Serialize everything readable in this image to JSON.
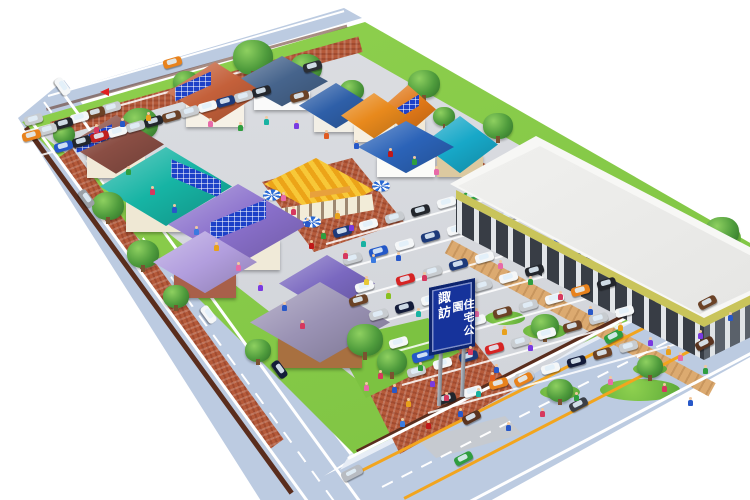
{
  "sign": {
    "line1": "諏訪",
    "line2": "住宅公園",
    "bg": "#16339b",
    "border": "#0d246e",
    "text_color": "#ffffff"
  },
  "palette": {
    "road": "#bccbe1",
    "sidewalk": "#e7edf6",
    "grass": "#7cc241",
    "grassLight": "#90d14f",
    "asphalt": "#d6d8dc",
    "brick": "#b55a3a",
    "tan": "#dcaa70",
    "band": "#c9c45a",
    "wallbrown": "#5a2d1d",
    "signBlue": "#16339b",
    "signBorder": "#0d246e",
    "lineOrange": "#f2a51e",
    "lineWhite": "#ffffff",
    "solarBlue": "#1d41c8"
  },
  "houses": [
    {
      "id": "spanish-tile-solar",
      "x": 215,
      "y": 98,
      "w": 96,
      "h": 72,
      "roof": "#c4603a",
      "wall": "#f6f1e6",
      "solar": "left"
    },
    {
      "id": "modern-white",
      "x": 282,
      "y": 86,
      "w": 92,
      "h": 60,
      "roof": "#46648c",
      "wall": "#fafafa",
      "solar": ""
    },
    {
      "id": "navy-roof",
      "x": 336,
      "y": 110,
      "w": 74,
      "h": 54,
      "roof": "#2e5fa8",
      "wall": "#f2efe6",
      "solar": ""
    },
    {
      "id": "orange-awning",
      "x": 374,
      "y": 120,
      "w": 66,
      "h": 54,
      "roof": "#e8891c",
      "wall": "#f6efe0",
      "solar": ""
    },
    {
      "id": "solar-gable",
      "x": 408,
      "y": 114,
      "w": 56,
      "h": 58,
      "roof": "#e07818",
      "wall": "#f2ead8",
      "solar": "center"
    },
    {
      "id": "blue-awning",
      "x": 406,
      "y": 152,
      "w": 96,
      "h": 62,
      "roof": "#2b63b8",
      "wall": "#fbfbf8",
      "solar": ""
    },
    {
      "id": "teal-mediterranean",
      "x": 460,
      "y": 150,
      "w": 76,
      "h": 68,
      "roof": "#17a8c8",
      "wall": "#dcc9a0",
      "solar": ""
    },
    {
      "id": "maroon-solar",
      "x": 116,
      "y": 150,
      "w": 96,
      "h": 70,
      "roof": "#8a4e44",
      "wall": "#f2ead8",
      "solar": "left"
    },
    {
      "id": "teal-big-solar",
      "x": 166,
      "y": 194,
      "w": 132,
      "h": 94,
      "roof": "#16b4a4",
      "wall": "#efe8d4",
      "solar": "right"
    },
    {
      "id": "violet-solar",
      "x": 238,
      "y": 232,
      "w": 140,
      "h": 96,
      "roof": "#8a70cc",
      "wall": "#f0ead8",
      "solar": "center"
    },
    {
      "id": "lavender-hip",
      "x": 205,
      "y": 268,
      "w": 104,
      "h": 74,
      "roof": "#b29ede",
      "wall": "#a8604a",
      "solar": ""
    },
    {
      "id": "purple-hip",
      "x": 327,
      "y": 289,
      "w": 96,
      "h": 68,
      "roof": "#7a68c0",
      "wall": "#8a5438",
      "solar": ""
    },
    {
      "id": "wood-lodge",
      "x": 320,
      "y": 330,
      "w": 140,
      "h": 96,
      "roof": "#9a92b4",
      "wall": "#a87040",
      "solar": ""
    }
  ],
  "cars": [
    [
      172,
      62,
      "#e8821c",
      -16
    ],
    [
      62,
      86,
      "#f5f7f8",
      54
    ],
    [
      86,
      198,
      "#9aa0a6",
      54
    ],
    [
      208,
      314,
      "#f5f7f8",
      54
    ],
    [
      279,
      369,
      "#141c3a",
      54
    ],
    [
      352,
      473,
      "#b8bcc2",
      -27,
      1
    ],
    [
      523,
      379,
      "#e8821c",
      -27
    ],
    [
      578,
      404,
      "#3a3f47",
      -27
    ],
    [
      471,
      417,
      "#5a3420",
      -27
    ],
    [
      463,
      458,
      "#2f9e3f",
      -27
    ],
    [
      613,
      336,
      "#2f9e3f",
      -27
    ],
    [
      704,
      343,
      "#5a3420",
      -27
    ],
    [
      707,
      302,
      "#6b4226",
      -27
    ],
    [
      33,
      119,
      "#c8ccd0",
      -15.5
    ],
    [
      31,
      135,
      "#e8821c",
      -15.5
    ],
    [
      47,
      129,
      "#c8ccd0",
      -15.5
    ],
    [
      63,
      123,
      "#23262c",
      -15.5
    ],
    [
      79,
      117,
      "#f5f7f8",
      -15.5
    ],
    [
      95,
      112,
      "#6b4226",
      -15.5
    ],
    [
      111,
      107,
      "#c8ccd0",
      -15.5
    ],
    [
      63,
      146,
      "#2458c8",
      -15.5
    ],
    [
      81,
      141,
      "#23262c",
      -15.5
    ],
    [
      99,
      136,
      "#c02020",
      -15.5
    ],
    [
      117,
      131,
      "#f5f7f8",
      -15.5
    ],
    [
      135,
      126,
      "#c8ccd0",
      -15.5
    ],
    [
      153,
      121,
      "#23262c",
      -15.5
    ],
    [
      171,
      116,
      "#6b4226",
      -15.5
    ],
    [
      189,
      111,
      "#c8ccd0",
      -15.5
    ],
    [
      207,
      106,
      "#f5f7f8",
      -15.5
    ],
    [
      225,
      101,
      "#1d3a7a",
      -15.5
    ],
    [
      243,
      96,
      "#c8ccd0",
      -15.5
    ],
    [
      261,
      91,
      "#23262c",
      -15.5
    ],
    [
      312,
      66,
      "#2a2e34",
      -15.5
    ],
    [
      299,
      96,
      "#6b4226",
      -15.5
    ],
    [
      342,
      231,
      "#1d3a7a",
      -15.5
    ],
    [
      368,
      224,
      "#f5f7f8",
      -15.5
    ],
    [
      394,
      217,
      "#c8ccd0",
      -15.5
    ],
    [
      420,
      210,
      "#23262c",
      -15.5
    ],
    [
      446,
      202,
      "#f5f7f8",
      -15.5
    ],
    [
      472,
      195,
      "#2f9e3f",
      -15.5
    ],
    [
      498,
      188,
      "#c8ccd0",
      -15.5
    ],
    [
      352,
      258,
      "#c8ccd0",
      -15.5
    ],
    [
      378,
      251,
      "#2458c8",
      -15.5
    ],
    [
      404,
      244,
      "#f5f7f8",
      -15.5
    ],
    [
      430,
      236,
      "#1d3a7a",
      -15.5
    ],
    [
      456,
      229,
      "#f5f7f8",
      -15.5
    ],
    [
      482,
      222,
      "#23262c",
      -15.5
    ],
    [
      508,
      215,
      "#c8ccd0",
      -15.5
    ],
    [
      534,
      207,
      "#6b4226",
      -15.5
    ],
    [
      364,
      286,
      "#f5f7f8",
      -15.5
    ],
    [
      405,
      279,
      "#d62424",
      -15.5
    ],
    [
      432,
      271,
      "#c8ccd0",
      -15.5
    ],
    [
      458,
      264,
      "#1d3a7a",
      -15.5
    ],
    [
      484,
      257,
      "#f5f7f8",
      -15.5
    ],
    [
      510,
      249,
      "#23262c",
      -15.5
    ],
    [
      536,
      242,
      "#c8ccd0",
      -15.5
    ],
    [
      562,
      235,
      "#2458c8",
      -15.5
    ],
    [
      378,
      314,
      "#c8ccd0",
      -15.5
    ],
    [
      404,
      307,
      "#141c3a",
      -15.5
    ],
    [
      430,
      299,
      "#f5f7f8",
      -15.5
    ],
    [
      456,
      292,
      "#6b4226",
      -15.5
    ],
    [
      482,
      285,
      "#c8ccd0",
      -15.5
    ],
    [
      508,
      277,
      "#f5f7f8",
      -15.5
    ],
    [
      534,
      270,
      "#23262c",
      -15.5
    ],
    [
      560,
      263,
      "#c8ccd0",
      -15.5
    ],
    [
      586,
      255,
      "#1d3a7a",
      -15.5
    ],
    [
      398,
      342,
      "#f5f7f8",
      -15.5
    ],
    [
      423,
      356,
      "#2458c8",
      -15.5,
      1
    ],
    [
      450,
      327,
      "#141c3a",
      -15.5
    ],
    [
      476,
      320,
      "#f5f7f8",
      -15.5
    ],
    [
      502,
      312,
      "#6b4226",
      -15.5
    ],
    [
      528,
      305,
      "#c8ccd0",
      -15.5
    ],
    [
      554,
      298,
      "#f5f7f8",
      -15.5
    ],
    [
      580,
      290,
      "#e8821c",
      -15.5
    ],
    [
      606,
      283,
      "#23262c",
      -15.5
    ],
    [
      416,
      371,
      "#c8ccd0",
      -15.5
    ],
    [
      442,
      363,
      "#f5f7f8",
      -15.5
    ],
    [
      468,
      356,
      "#1d3a7a",
      -15.5
    ],
    [
      494,
      348,
      "#d62424",
      -15.5
    ],
    [
      520,
      341,
      "#c8ccd0",
      -15.5
    ],
    [
      546,
      333,
      "#f5f7f8",
      -15.5
    ],
    [
      572,
      326,
      "#6b4226",
      -15.5
    ],
    [
      598,
      318,
      "#c8ccd0",
      -15.5
    ],
    [
      624,
      311,
      "#f5f7f8",
      -15.5
    ],
    [
      446,
      398,
      "#23262c",
      -15.5
    ],
    [
      472,
      391,
      "#f5f7f8",
      -15.5
    ],
    [
      498,
      383,
      "#e8821c",
      -15.5
    ],
    [
      524,
      376,
      "#c8ccd0",
      -15.5
    ],
    [
      550,
      368,
      "#f5f7f8",
      -15.5
    ],
    [
      576,
      361,
      "#141c3a",
      -15.5
    ],
    [
      602,
      353,
      "#6b4226",
      -15.5
    ],
    [
      628,
      346,
      "#c8ccd0",
      -15.5
    ],
    [
      358,
      300,
      "#6b4226",
      -15.5
    ]
  ],
  "trees": [
    [
      140,
      126,
      36
    ],
    [
      97,
      148,
      30
    ],
    [
      64,
      136,
      22
    ],
    [
      186,
      84,
      26
    ],
    [
      253,
      60,
      40
    ],
    [
      306,
      70,
      32
    ],
    [
      352,
      92,
      24
    ],
    [
      424,
      86,
      32
    ],
    [
      444,
      118,
      22
    ],
    [
      498,
      128,
      30
    ],
    [
      108,
      208,
      32
    ],
    [
      143,
      256,
      32
    ],
    [
      176,
      298,
      26
    ],
    [
      322,
      298,
      24
    ],
    [
      258,
      352,
      26
    ],
    [
      365,
      342,
      36
    ],
    [
      392,
      364,
      30
    ],
    [
      545,
      328,
      28
    ],
    [
      560,
      392,
      26
    ],
    [
      650,
      368,
      26
    ],
    [
      722,
      234,
      34
    ],
    [
      736,
      258,
      24
    ]
  ],
  "people_colors": [
    "#d6385e",
    "#e86aa8",
    "#2858c8",
    "#2f9e3f",
    "#e8a11c",
    "#7a3ae0",
    "#18b2a2",
    "#e05a20",
    "#c01818",
    "#3a7ae0",
    "#88c020",
    "#e8c838"
  ],
  "people": [
    [
      96,
      133,
      0
    ],
    [
      122,
      127,
      2
    ],
    [
      148,
      121,
      4
    ],
    [
      210,
      127,
      1
    ],
    [
      240,
      131,
      3
    ],
    [
      266,
      125,
      6
    ],
    [
      296,
      129,
      5
    ],
    [
      326,
      139,
      7
    ],
    [
      356,
      149,
      2
    ],
    [
      390,
      157,
      8
    ],
    [
      414,
      165,
      3
    ],
    [
      436,
      175,
      1
    ],
    [
      128,
      175,
      3
    ],
    [
      152,
      195,
      0
    ],
    [
      174,
      213,
      2
    ],
    [
      196,
      235,
      9
    ],
    [
      216,
      251,
      4
    ],
    [
      238,
      271,
      1
    ],
    [
      260,
      291,
      5
    ],
    [
      284,
      311,
      2
    ],
    [
      302,
      329,
      0
    ],
    [
      283,
      201,
      1
    ],
    [
      293,
      215,
      0
    ],
    [
      307,
      227,
      2
    ],
    [
      323,
      239,
      3
    ],
    [
      337,
      219,
      4
    ],
    [
      351,
      231,
      5
    ],
    [
      363,
      247,
      6
    ],
    [
      345,
      259,
      0
    ],
    [
      311,
      249,
      8
    ],
    [
      373,
      263,
      9
    ],
    [
      398,
      261,
      2
    ],
    [
      424,
      281,
      0
    ],
    [
      450,
      299,
      3
    ],
    [
      476,
      317,
      1
    ],
    [
      504,
      335,
      4
    ],
    [
      530,
      351,
      5
    ],
    [
      418,
      317,
      6
    ],
    [
      446,
      337,
      7
    ],
    [
      470,
      355,
      0
    ],
    [
      496,
      373,
      2
    ],
    [
      388,
      299,
      10
    ],
    [
      366,
      285,
      11
    ],
    [
      500,
      269,
      1
    ],
    [
      530,
      285,
      3
    ],
    [
      560,
      300,
      0
    ],
    [
      590,
      315,
      2
    ],
    [
      620,
      331,
      4
    ],
    [
      650,
      346,
      5
    ],
    [
      680,
      361,
      1
    ],
    [
      705,
      374,
      3
    ],
    [
      380,
      379,
      0
    ],
    [
      394,
      393,
      2
    ],
    [
      408,
      407,
      4
    ],
    [
      366,
      391,
      1
    ],
    [
      420,
      371,
      3
    ],
    [
      432,
      387,
      5
    ],
    [
      446,
      401,
      0
    ],
    [
      460,
      417,
      2
    ],
    [
      478,
      397,
      6
    ],
    [
      492,
      381,
      7
    ],
    [
      428,
      429,
      8
    ],
    [
      402,
      427,
      9
    ],
    [
      508,
      431,
      2
    ],
    [
      542,
      417,
      0
    ],
    [
      576,
      401,
      3
    ],
    [
      610,
      385,
      1
    ],
    [
      668,
      355,
      4
    ],
    [
      700,
      339,
      5
    ],
    [
      730,
      321,
      2
    ],
    [
      664,
      392,
      0
    ],
    [
      690,
      406,
      2
    ]
  ],
  "umbrellas": [
    [
      272,
      195
    ],
    [
      312,
      222
    ],
    [
      381,
      186
    ]
  ],
  "stripes": [
    [
      30,
      118,
      480,
      3,
      54,
      "#ffffff",
      null
    ],
    [
      59,
      86,
      520,
      3,
      54,
      "#ffffff",
      null
    ],
    [
      44,
      101,
      500,
      2,
      54,
      "#ffffff",
      [
        13,
        11
      ]
    ],
    [
      48,
      95,
      308,
      2,
      -16,
      "#ffffff",
      null
    ],
    [
      348,
      457,
      452,
      3,
      -26.8,
      "#ffffff",
      null
    ],
    [
      358,
      471,
      440,
      2.5,
      -26.8,
      "#f2a51e",
      null
    ],
    [
      404,
      497,
      392,
      2.5,
      -27.3,
      "#f2a51e",
      null
    ],
    [
      470,
      500,
      320,
      3,
      -27.8,
      "#ffffff",
      null
    ],
    [
      382,
      486,
      404,
      2,
      -27,
      "#ffffff",
      [
        12,
        10
      ]
    ],
    [
      326,
      243,
      205,
      2,
      -15.5,
      "rgba(255,255,255,.85)",
      null
    ],
    [
      336,
      270,
      235,
      2,
      -15.5,
      "rgba(255,255,255,.85)",
      null
    ],
    [
      348,
      298,
      265,
      2,
      -15.5,
      "rgba(255,255,255,.85)",
      null
    ],
    [
      362,
      326,
      290,
      2,
      -15.5,
      "rgba(255,255,255,.85)",
      null
    ],
    [
      380,
      355,
      300,
      2,
      -15.5,
      "rgba(255,255,255,.85)",
      null
    ],
    [
      402,
      384,
      300,
      2,
      -15.5,
      "rgba(255,255,255,.85)",
      null
    ],
    [
      428,
      412,
      285,
      2,
      -15.5,
      "rgba(255,255,255,.85)",
      null
    ],
    [
      24,
      131,
      240,
      2,
      -15.5,
      "rgba(255,255,255,.85)",
      null
    ],
    [
      27,
      158,
      140,
      2,
      -15.5,
      "rgba(255,255,255,.85)",
      null
    ]
  ],
  "islands": [
    [
      505,
      318,
      40,
      14
    ],
    [
      545,
      331,
      44,
      16
    ],
    [
      560,
      392,
      40,
      14
    ],
    [
      650,
      369,
      34,
      12
    ],
    [
      718,
      238,
      46,
      32
    ],
    [
      640,
      390,
      80,
      22
    ]
  ]
}
